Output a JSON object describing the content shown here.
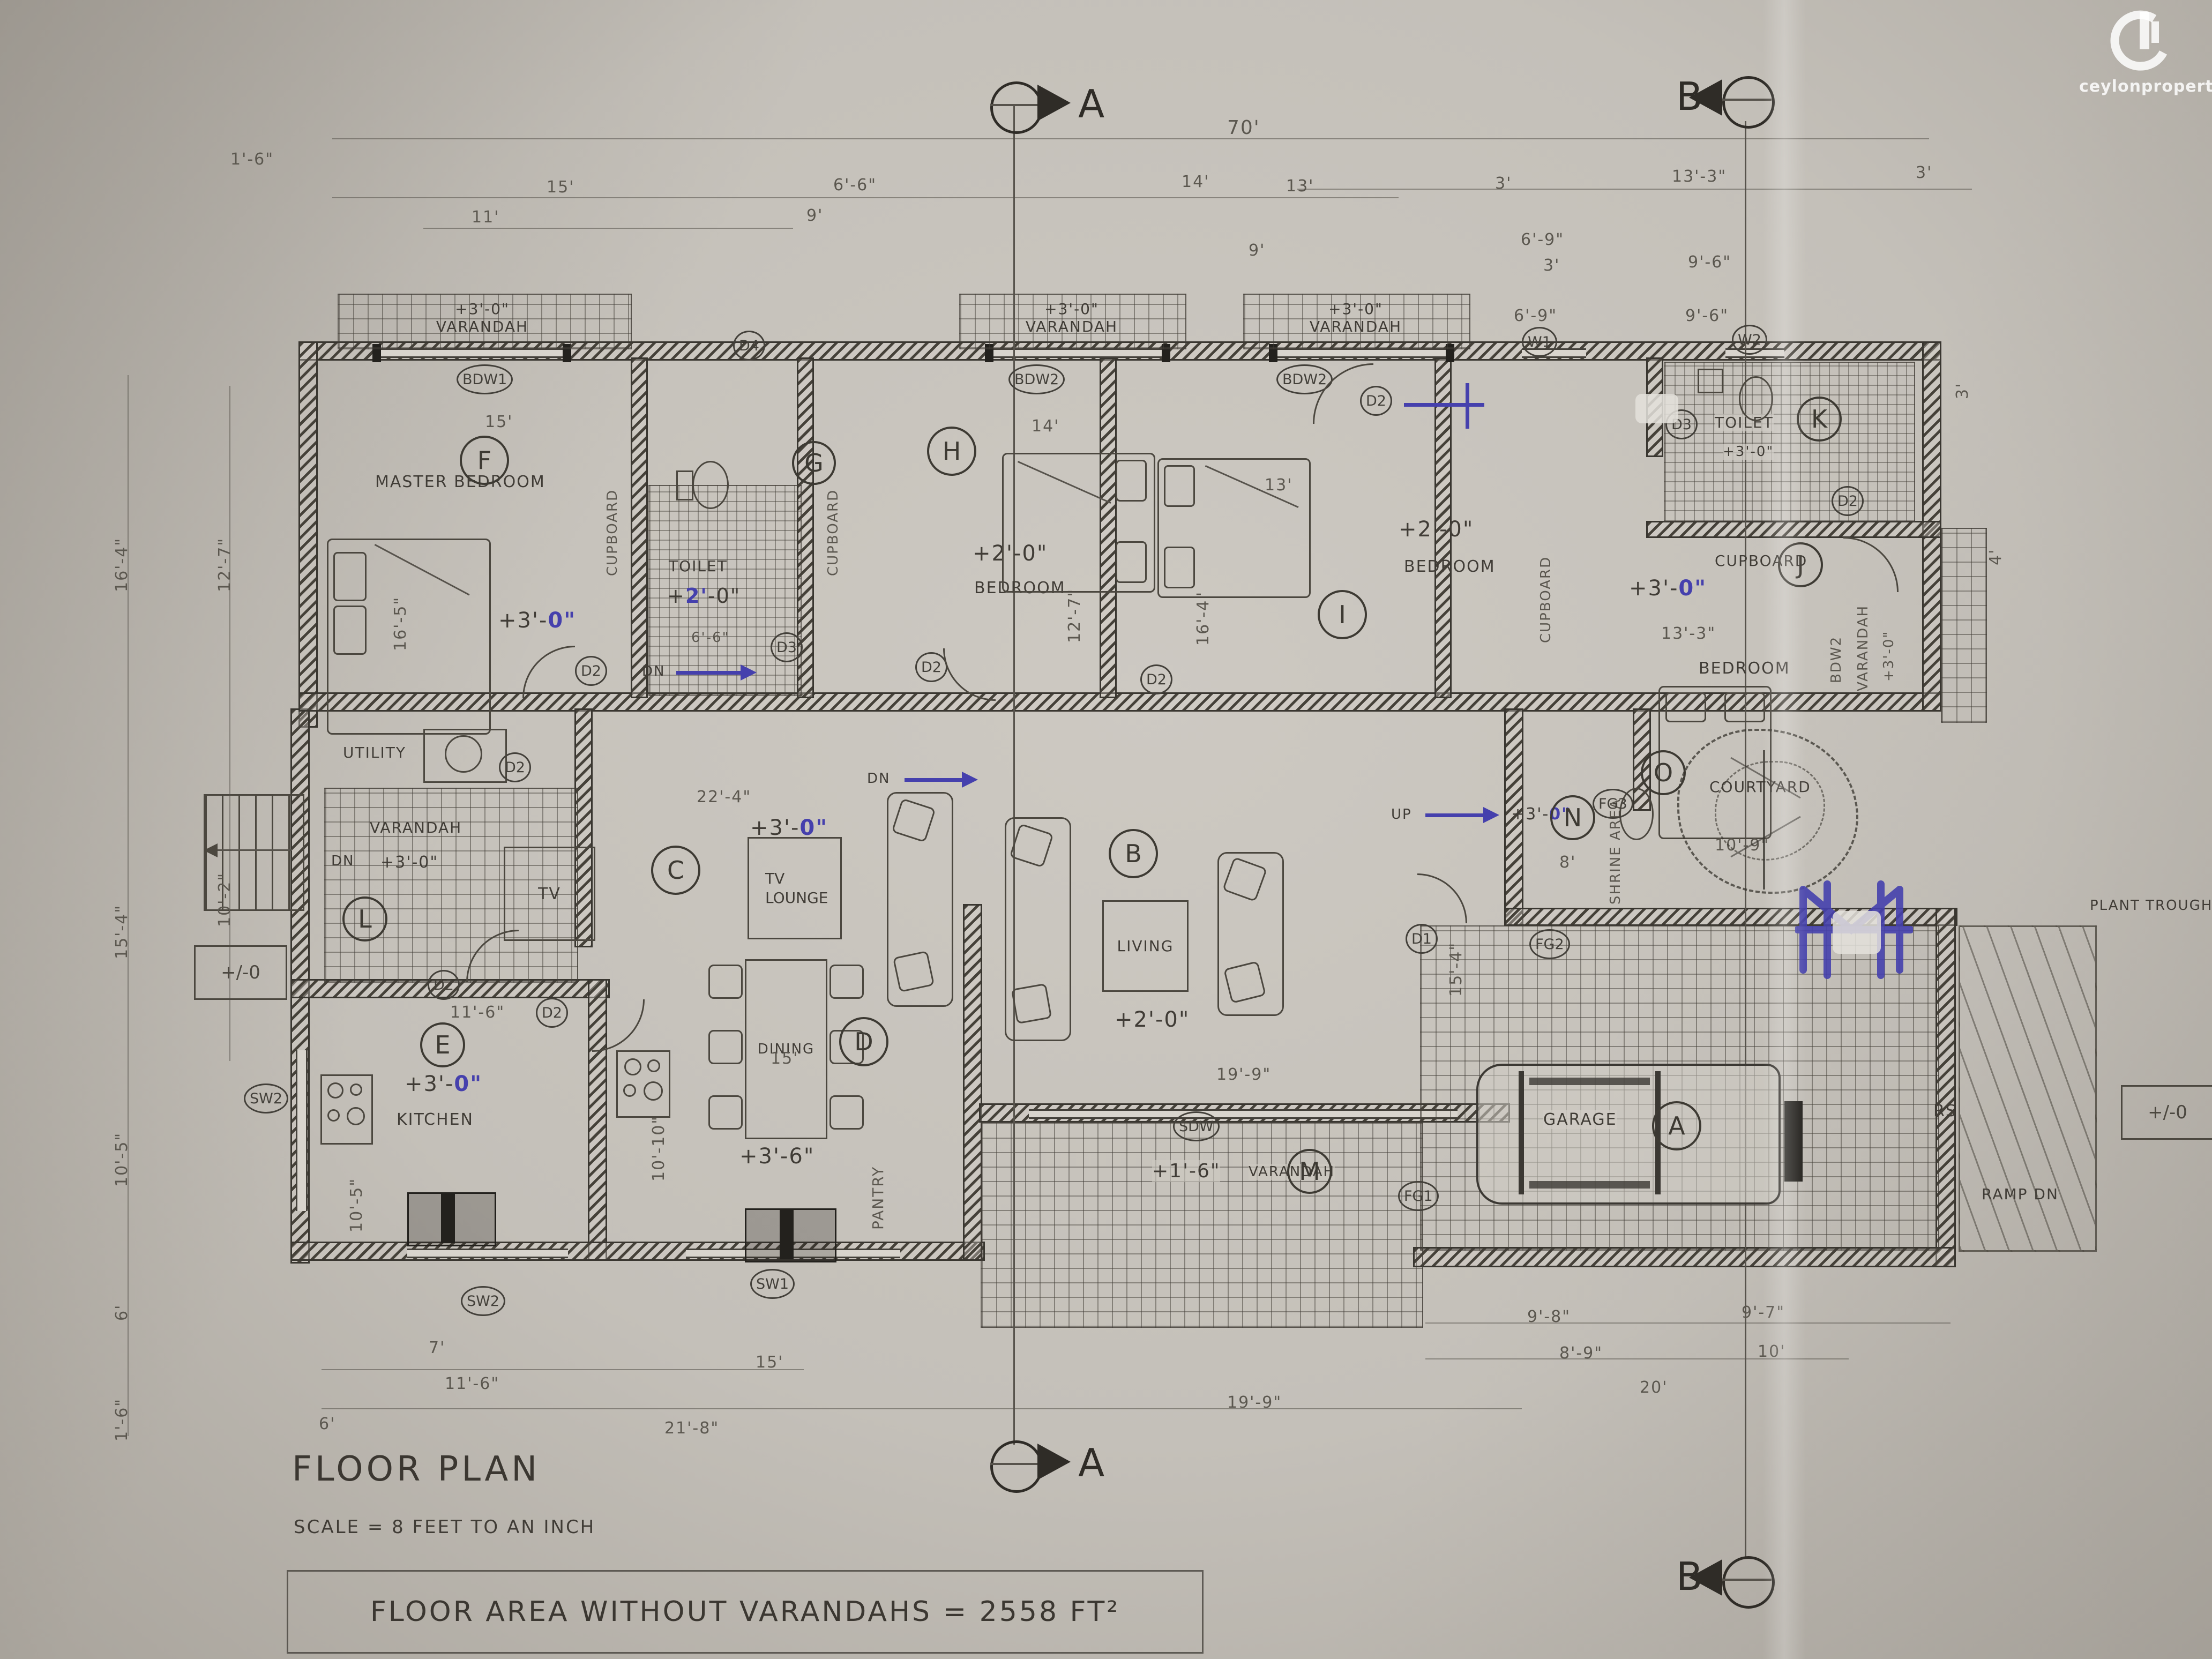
{
  "brand": {
    "name": "ceylonproperty",
    "tld": ".lk"
  },
  "titles": {
    "floor_plan": "FLOOR PLAN",
    "scale": "SCALE = 8 FEET TO AN INCH",
    "area": "FLOOR AREA WITHOUT VARANDAHS = 2558 FT²"
  },
  "sections": {
    "a": "A",
    "b": "B"
  },
  "markers": {
    "a": "A",
    "b": "B",
    "c": "C",
    "d": "D",
    "e": "E",
    "f": "F",
    "g": "G",
    "h": "H",
    "i": "I",
    "j": "J",
    "k": "K",
    "l": "L",
    "m": "M",
    "n": "N",
    "o": "O"
  },
  "rooms": {
    "master": {
      "name": "MASTER BEDROOM",
      "lvl_pre": "+3'-",
      "lvl_blue": "0\""
    },
    "toilet_g": {
      "name": "TOILET",
      "lvl_pre": "+",
      "lvl_blue": "2'",
      "lvl_post": "-0\""
    },
    "bed_h": {
      "name": "BEDROOM",
      "lvl": "+2'-0\""
    },
    "bed_i": {
      "name": "BEDROOM",
      "lvl": "+2'-0\""
    },
    "bed_j": {
      "name": "BEDROOM",
      "lvl_pre": "+3'-",
      "lvl_blue": "0\""
    },
    "toilet_k": {
      "name": "TOILET",
      "lvl": "+3'-0\""
    },
    "tv_lounge": {
      "name": "TV LOUNGE",
      "lvl_pre": "+3'-",
      "lvl_blue": "0\"",
      "tv": "TV"
    },
    "dining": {
      "name": "DINING",
      "lvl": "+3'-6\""
    },
    "living": {
      "name": "LIVING",
      "lvl": "+2'-0\""
    },
    "kitchen": {
      "name": "KITCHEN",
      "lvl_pre": "+3'-",
      "lvl_blue": "0\""
    },
    "pantry": {
      "name": "PANTRY"
    },
    "utility": {
      "name": "UTILITY"
    },
    "var_l": {
      "name": "VARANDAH",
      "dn": "DN",
      "lvl": "+3'-0\""
    },
    "shrine": {
      "name": "SHRINE AREA",
      "up": "UP",
      "lvl_pre": "+3'-",
      "lvl_blue": "0\""
    },
    "courtyard": {
      "name": "COURTYARD"
    },
    "garage": {
      "name": "GARAGE"
    },
    "var_m": {
      "name": "VARANDAH",
      "lvl": "+1'-6\""
    },
    "var_top": {
      "name": "VARANDAH",
      "lvl": "+3'-0\""
    },
    "var_j": {
      "name": "VARANDAH",
      "lvl": "+3'-0\""
    },
    "cupboard": "CUPBOARD",
    "dn": "DN"
  },
  "openings": {
    "bdw1": "BDW1",
    "bdw2": "BDW2",
    "w1": "W1",
    "w2": "W2",
    "d1": "D1",
    "d2": "D2",
    "d3": "D3",
    "d4": "D4",
    "sw1": "SW1",
    "sw2": "SW2",
    "sdw": "SDW",
    "fg1": "FG1",
    "fg2": "FG2",
    "fg3": "FG3",
    "rs": "RS"
  },
  "site": {
    "ramp": "RAMP DN",
    "plant_trough": "PLANT TROUGH",
    "level_zero": "+/-0"
  },
  "dims": {
    "ft1_6": "1'-6\"",
    "ft70": "70'",
    "ft15": "15'",
    "ft6_6": "6'-6\"",
    "ft14": "14'",
    "ft13": "13'",
    "ft3": "3'",
    "ft13_3": "13'-3\"",
    "ft11": "11'",
    "ft9": "9'",
    "ft6_9": "6'-9\"",
    "ft9_6": "9'-6\"",
    "ft16_4": "16'-4\"",
    "ft15_4": "15'-4\"",
    "ft10_5": "10'-5\"",
    "ft6": "6'",
    "ft12_7": "12'-7\"",
    "ft10_2": "10'-2\"",
    "ft16_5": "16'-5\"",
    "ft22_4": "22'-4\"",
    "ft10_10": "10'-10\"",
    "ft11_6": "11'-6\"",
    "ft19_9": "19'-9\"",
    "ft8": "8'",
    "ft7": "7'",
    "ft21_8": "21'-8\"",
    "ft9_8": "9'-8\"",
    "ft9_7": "9'-7\"",
    "ft8_9": "8'-9\"",
    "ft10": "10'",
    "ft20": "20'",
    "ft4": "4'",
    "ft10_9": "10'-9\""
  }
}
